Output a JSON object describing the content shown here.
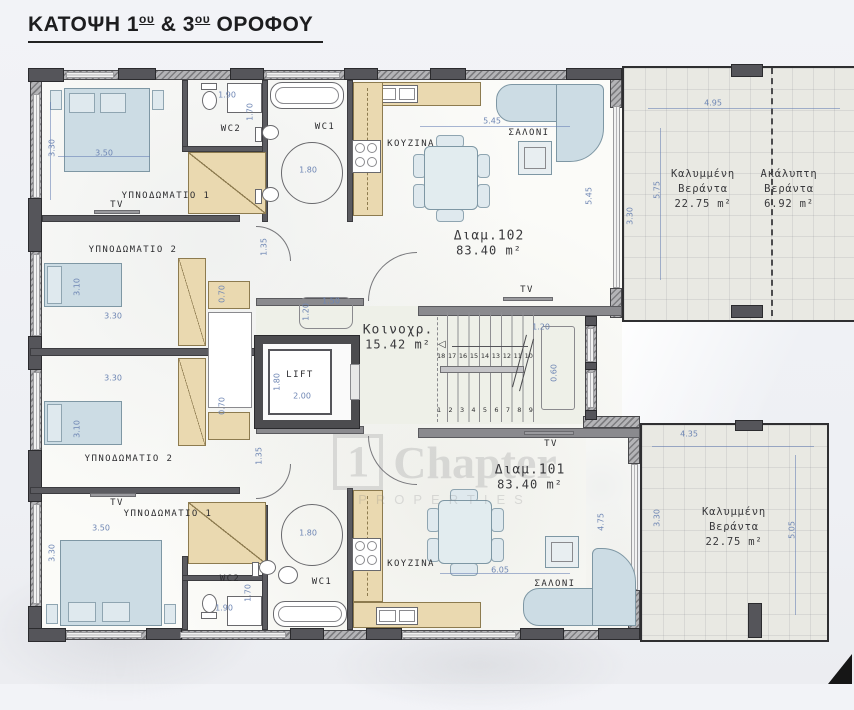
{
  "title": {
    "p1": "ΚΑΤΟΨΗ 1",
    "sup1": "ου",
    "p2": " & 3",
    "sup2": "ου",
    "p3": " ΟΡΟΦΟΥ"
  },
  "watermark": {
    "logo": "1",
    "brand": "Chapter",
    "sub": "PROPERTIES"
  },
  "lift": {
    "label": "LIFT"
  },
  "icons": {
    "stairs_up_arrow": "◁"
  },
  "colors": {
    "wall": "#7d7d80",
    "column": "#55555a",
    "dimension_text": "#6e86b4",
    "wardrobe_tan": "#ead9b0",
    "furniture_blue": "#ccdce4",
    "veranda_floor": "#e9e9e3",
    "core_floor": "#eef0e8",
    "title_text": "#1d1d1f"
  },
  "stairs": {
    "top_row": [
      "18",
      "17",
      "16",
      "15",
      "14",
      "13",
      "12",
      "11",
      "10"
    ],
    "bottom_row": [
      "1",
      "2",
      "3",
      "4",
      "5",
      "6",
      "7",
      "8",
      "9"
    ]
  },
  "apt_labels": [
    {
      "name": "Διαμ.102",
      "area": "83.40 m²",
      "x": 489,
      "y": 243
    },
    {
      "name": "Διαμ.101",
      "area": "83.40 m²",
      "x": 530,
      "y": 477
    },
    {
      "name": "Κοινοχρ.",
      "area": "15.42 m²",
      "x": 398,
      "y": 337
    }
  ],
  "veranda_labels": [
    {
      "lines": [
        "Καλυμμένη",
        "Βεράντα",
        "22.75 m²"
      ],
      "x": 703,
      "y": 190
    },
    {
      "lines": [
        "Ακάλυπτη",
        "Βεράντα",
        "6.92 m²"
      ],
      "x": 789,
      "y": 190
    },
    {
      "lines": [
        "Καλυμμένη",
        "Βεράντα",
        "22.75 m²"
      ],
      "x": 734,
      "y": 528
    }
  ],
  "room_labels": [
    {
      "text": "ΥΠΝΟΔΩΜΑΤΙΟ 1",
      "x": 166,
      "y": 196
    },
    {
      "text": "TV",
      "x": 117,
      "y": 205
    },
    {
      "text": "WC2",
      "x": 231,
      "y": 129
    },
    {
      "text": "WC1",
      "x": 325,
      "y": 127
    },
    {
      "text": "ΚΟΥΖΙΝΑ",
      "x": 411,
      "y": 144
    },
    {
      "text": "ΣΑΛΟΝΙ",
      "x": 529,
      "y": 133
    },
    {
      "text": "ΥΠΝΟΔΩΜΑΤΙΟ 2",
      "x": 133,
      "y": 250
    },
    {
      "text": "ΥΠΝΟΔΩΜΑΤΙΟ 2",
      "x": 129,
      "y": 459
    },
    {
      "text": "TV",
      "x": 527,
      "y": 290
    },
    {
      "text": "ΥΠΝΟΔΩΜΑΤΙΟ 1",
      "x": 168,
      "y": 514
    },
    {
      "text": "TV",
      "x": 117,
      "y": 503
    },
    {
      "text": "WC2",
      "x": 230,
      "y": 579
    },
    {
      "text": "WC1",
      "x": 322,
      "y": 582
    },
    {
      "text": "ΚΟΥΖΙΝΑ",
      "x": 411,
      "y": 564
    },
    {
      "text": "ΣΑΛΟΝΙ",
      "x": 555,
      "y": 584
    },
    {
      "text": "TV",
      "x": 551,
      "y": 444
    }
  ],
  "dimensions": [
    {
      "v": "3.30",
      "x": 52,
      "y": 148,
      "rot": 1
    },
    {
      "v": "3.50",
      "x": 104,
      "y": 153
    },
    {
      "v": "1.90",
      "x": 227,
      "y": 95
    },
    {
      "v": "1.70",
      "x": 250,
      "y": 112,
      "rot": 1
    },
    {
      "v": "1.80",
      "x": 308,
      "y": 170
    },
    {
      "v": "5.45",
      "x": 492,
      "y": 121
    },
    {
      "v": "5.45",
      "x": 589,
      "y": 196,
      "rot": 1
    },
    {
      "v": "3.30",
      "x": 630,
      "y": 216,
      "rot": 1
    },
    {
      "v": "5.75",
      "x": 657,
      "y": 190,
      "rot": 1
    },
    {
      "v": "4.95",
      "x": 713,
      "y": 103
    },
    {
      "v": "3.10",
      "x": 77,
      "y": 287,
      "rot": 1
    },
    {
      "v": "3.30",
      "x": 113,
      "y": 316
    },
    {
      "v": "0.70",
      "x": 222,
      "y": 294,
      "rot": 1
    },
    {
      "v": "1.35",
      "x": 264,
      "y": 247,
      "rot": 1
    },
    {
      "v": "1.50",
      "x": 331,
      "y": 301
    },
    {
      "v": "1.20",
      "x": 306,
      "y": 312,
      "rot": 1
    },
    {
      "v": "1.80",
      "x": 277,
      "y": 382,
      "rot": 1
    },
    {
      "v": "2.00",
      "x": 302,
      "y": 396
    },
    {
      "v": "1.20",
      "x": 541,
      "y": 327
    },
    {
      "v": "0.60",
      "x": 554,
      "y": 373,
      "rot": 1
    },
    {
      "v": "3.30",
      "x": 113,
      "y": 378
    },
    {
      "v": "3.10",
      "x": 77,
      "y": 429,
      "rot": 1
    },
    {
      "v": "0.70",
      "x": 222,
      "y": 406,
      "rot": 1
    },
    {
      "v": "1.35",
      "x": 259,
      "y": 456,
      "rot": 1
    },
    {
      "v": "3.50",
      "x": 101,
      "y": 528
    },
    {
      "v": "3.30",
      "x": 52,
      "y": 553,
      "rot": 1
    },
    {
      "v": "1.90",
      "x": 224,
      "y": 608
    },
    {
      "v": "1.70",
      "x": 248,
      "y": 593,
      "rot": 1
    },
    {
      "v": "1.80",
      "x": 308,
      "y": 533
    },
    {
      "v": "6.05",
      "x": 500,
      "y": 570
    },
    {
      "v": "4.75",
      "x": 601,
      "y": 522,
      "rot": 1
    },
    {
      "v": "4.35",
      "x": 689,
      "y": 434
    },
    {
      "v": "3.30",
      "x": 657,
      "y": 518,
      "rot": 1
    },
    {
      "v": "5.05",
      "x": 792,
      "y": 530,
      "rot": 1
    }
  ]
}
